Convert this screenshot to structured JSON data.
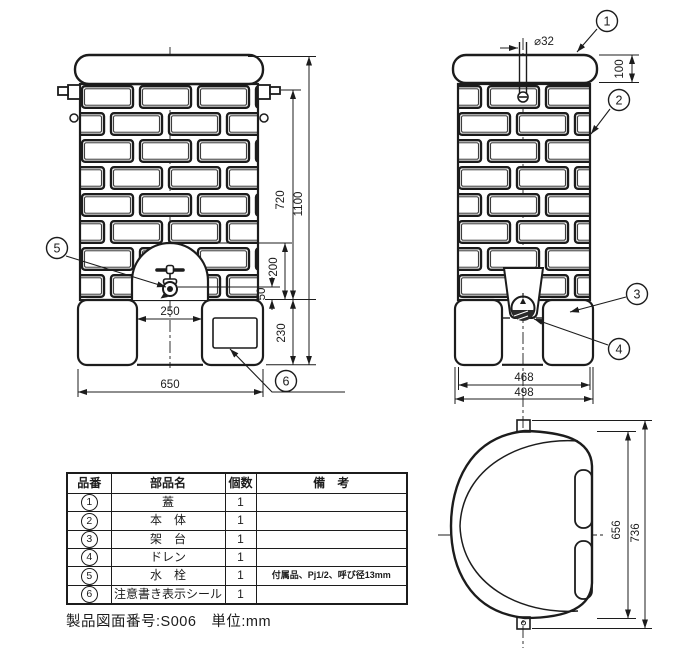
{
  "dims": {
    "front": {
      "body_height": "720",
      "total_height": "1100",
      "niche_height": "200",
      "faucet_height": "50",
      "base_height": "230",
      "niche_width": "250",
      "total_width": "650"
    },
    "side": {
      "pipe_dia": "⌀32",
      "lid_height": "100",
      "inner_width": "468",
      "outer_width": "498"
    },
    "top": {
      "inner_depth": "656",
      "outer_depth": "736"
    }
  },
  "balloons": {
    "b1": "1",
    "b2": "2",
    "b3": "3",
    "b4": "4",
    "b5": "5",
    "b6": "6"
  },
  "table": {
    "headers": {
      "no": "品番",
      "name": "部品名",
      "qty": "個数",
      "remarks": "備　考"
    },
    "rows": [
      {
        "no": "1",
        "name": "蓋",
        "qty": "1",
        "remark": ""
      },
      {
        "no": "2",
        "name": "本　体",
        "qty": "1",
        "remark": ""
      },
      {
        "no": "3",
        "name": "架　台",
        "qty": "1",
        "remark": ""
      },
      {
        "no": "4",
        "name": "ドレン",
        "qty": "1",
        "remark": ""
      },
      {
        "no": "5",
        "name": "水　栓",
        "qty": "1",
        "remark": "付属品、Pj1/2、呼び径13mm"
      },
      {
        "no": "6",
        "name": "注意書き表示シール",
        "qty": "1",
        "remark": ""
      }
    ]
  },
  "meta": {
    "footer": "製品図面番号:S006　単位:mm"
  }
}
